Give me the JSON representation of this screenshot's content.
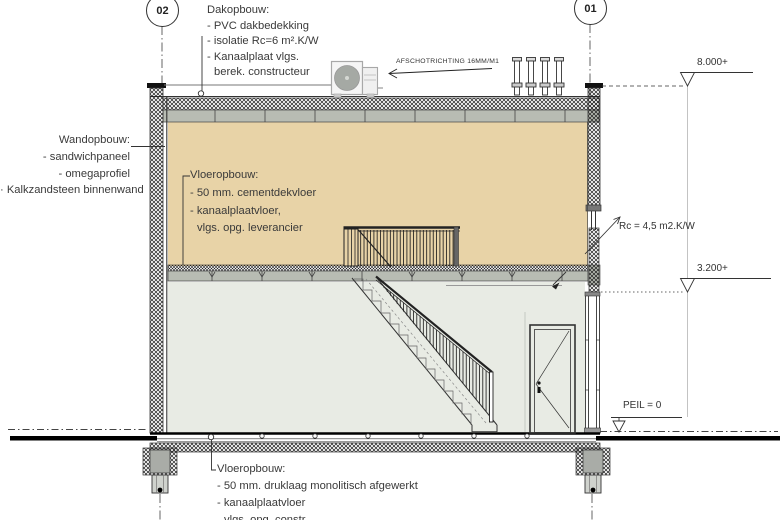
{
  "grid": {
    "left": "02",
    "right": "01"
  },
  "levels": {
    "roof": "8.000+",
    "floor": "3.200+",
    "ground": "PEIL = 0"
  },
  "annotations": {
    "dakopbouw": {
      "title": "Dakopbouw:",
      "items": [
        "- PVC dakbedekking",
        "- isolatie Rc=6 m².K/W",
        "- Kanaalplaat vlgs.",
        "berek. constructeur"
      ]
    },
    "wandopbouw": {
      "title": "Wandopbouw:",
      "items": [
        "- sandwichpaneel",
        "- omegaprofiel",
        "· Kalkzandsteen binnenwand"
      ]
    },
    "vloer_verdieping": {
      "title": "Vloeropbouw:",
      "items": [
        "- 50 mm. cementdekvloer",
        "- kanaalplaatvloer,",
        "vlgs. opg. leverancier"
      ]
    },
    "vloer_begane_grond": {
      "title": "Vloeropbouw:",
      "items": [
        "- 50 mm. druklaag monolitisch afgewerkt",
        "- kanaalplaatvloer",
        "vlgs. opg. constr."
      ]
    },
    "afschot": "AFSCHOTRICHTING 16MM/M1",
    "rc_gevel": "Rc = 4,5 m2.K/W"
  },
  "colors": {
    "upper_room": "#e8d3a7",
    "lower_room": "#e8ebe4",
    "slab_gray": "#b8bcb3",
    "foundation_gray": "#a9aca7",
    "ground_black": "#000000"
  }
}
